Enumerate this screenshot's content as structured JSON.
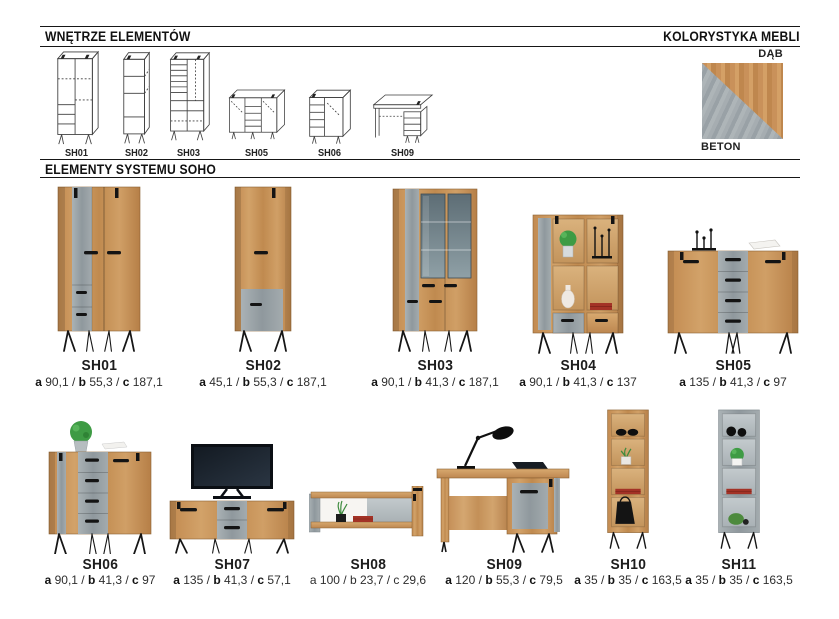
{
  "sections": {
    "interiors": {
      "title": "WNĘTRZE ELEMENTÓW"
    },
    "colors": {
      "title": "KOLORYSTYKA MEBLI",
      "dab_label": "DĄB",
      "beton_label": "BETON"
    },
    "elements": {
      "title": "ELEMENTY SYSTEMU SOHO"
    }
  },
  "palette": {
    "oak": "#c6905a",
    "oak_light": "#d4a066",
    "beton": "#9aa2a7",
    "metal_black": "#161616",
    "rule_black": "#161616",
    "plant_green": "#3e9b44",
    "book_red": "#a33226"
  },
  "diagrams": [
    {
      "label": "SH01"
    },
    {
      "label": "SH02"
    },
    {
      "label": "SH03"
    },
    {
      "label": "SH05"
    },
    {
      "label": "SH06"
    },
    {
      "label": "SH09"
    }
  ],
  "dim_labels": {
    "a": "a",
    "b": "b",
    "c": "c",
    "sep": "/"
  },
  "products": [
    {
      "name": "SH01",
      "dims": {
        "a": "90,1",
        "b": "55,3",
        "c": "187,1"
      }
    },
    {
      "name": "SH02",
      "dims": {
        "a": "45,1",
        "b": "55,3",
        "c": "187,1"
      }
    },
    {
      "name": "SH03",
      "dims": {
        "a": "90,1",
        "b": "41,3",
        "c": "187,1"
      }
    },
    {
      "name": "SH04",
      "dims": {
        "a": "90,1",
        "b": "41,3",
        "c": "137"
      }
    },
    {
      "name": "SH05",
      "dims": {
        "a": "135",
        "b": "41,3",
        "c": "97"
      }
    },
    {
      "name": "SH06",
      "dims": {
        "a": "90,1",
        "b": "41,3",
        "c": "97"
      }
    },
    {
      "name": "SH07",
      "dims": {
        "a": "135",
        "b": "41,3",
        "c": "57,1"
      }
    },
    {
      "name": "SH08",
      "dims": {
        "a": "100",
        "b": "23,7",
        "c": "29,6"
      }
    },
    {
      "name": "SH09",
      "dims": {
        "a": "120",
        "b": "55,3",
        "c": "79,5"
      }
    },
    {
      "name": "SH10",
      "dims": {
        "a": "35",
        "b": "35",
        "c": "163,5"
      }
    },
    {
      "name": "SH11",
      "dims": {
        "a": "35",
        "b": "35",
        "c": "163,5"
      }
    }
  ]
}
